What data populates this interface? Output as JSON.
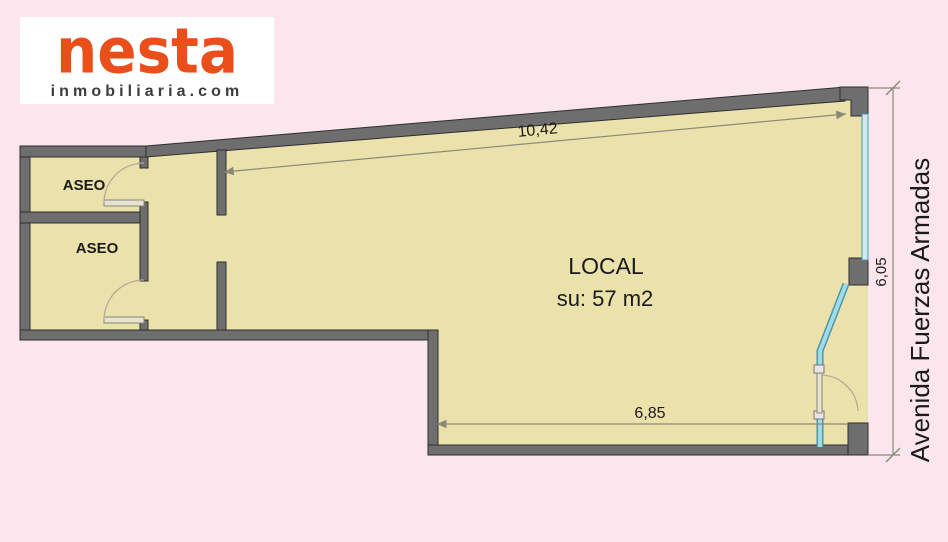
{
  "logo": {
    "name": "nesta",
    "subtitle": "inmobiliaria.com"
  },
  "plan": {
    "room_labels": {
      "aseo_upper": "ASEO",
      "aseo_lower": "ASEO",
      "local_title": "LOCAL",
      "local_area": "su: 57 m2"
    },
    "dimensions": {
      "top_width": "10,42",
      "bottom_width": "6,85",
      "right_height": "6,05"
    },
    "street_label": "Avenida Fuerzas Armadas"
  },
  "colors": {
    "bg": "#fce6ee",
    "logobg": "#ffffff",
    "brand": "#e94e1b",
    "brandsub": "#3c3c3b",
    "wall": "#6e6e6e",
    "wallline": "#2e2e2e",
    "floor": "#ebe1ab",
    "glass": "#9fdbe8",
    "glassline": "#4e96a8",
    "dim": "#8a8878",
    "ink": "#1a1a1a"
  }
}
